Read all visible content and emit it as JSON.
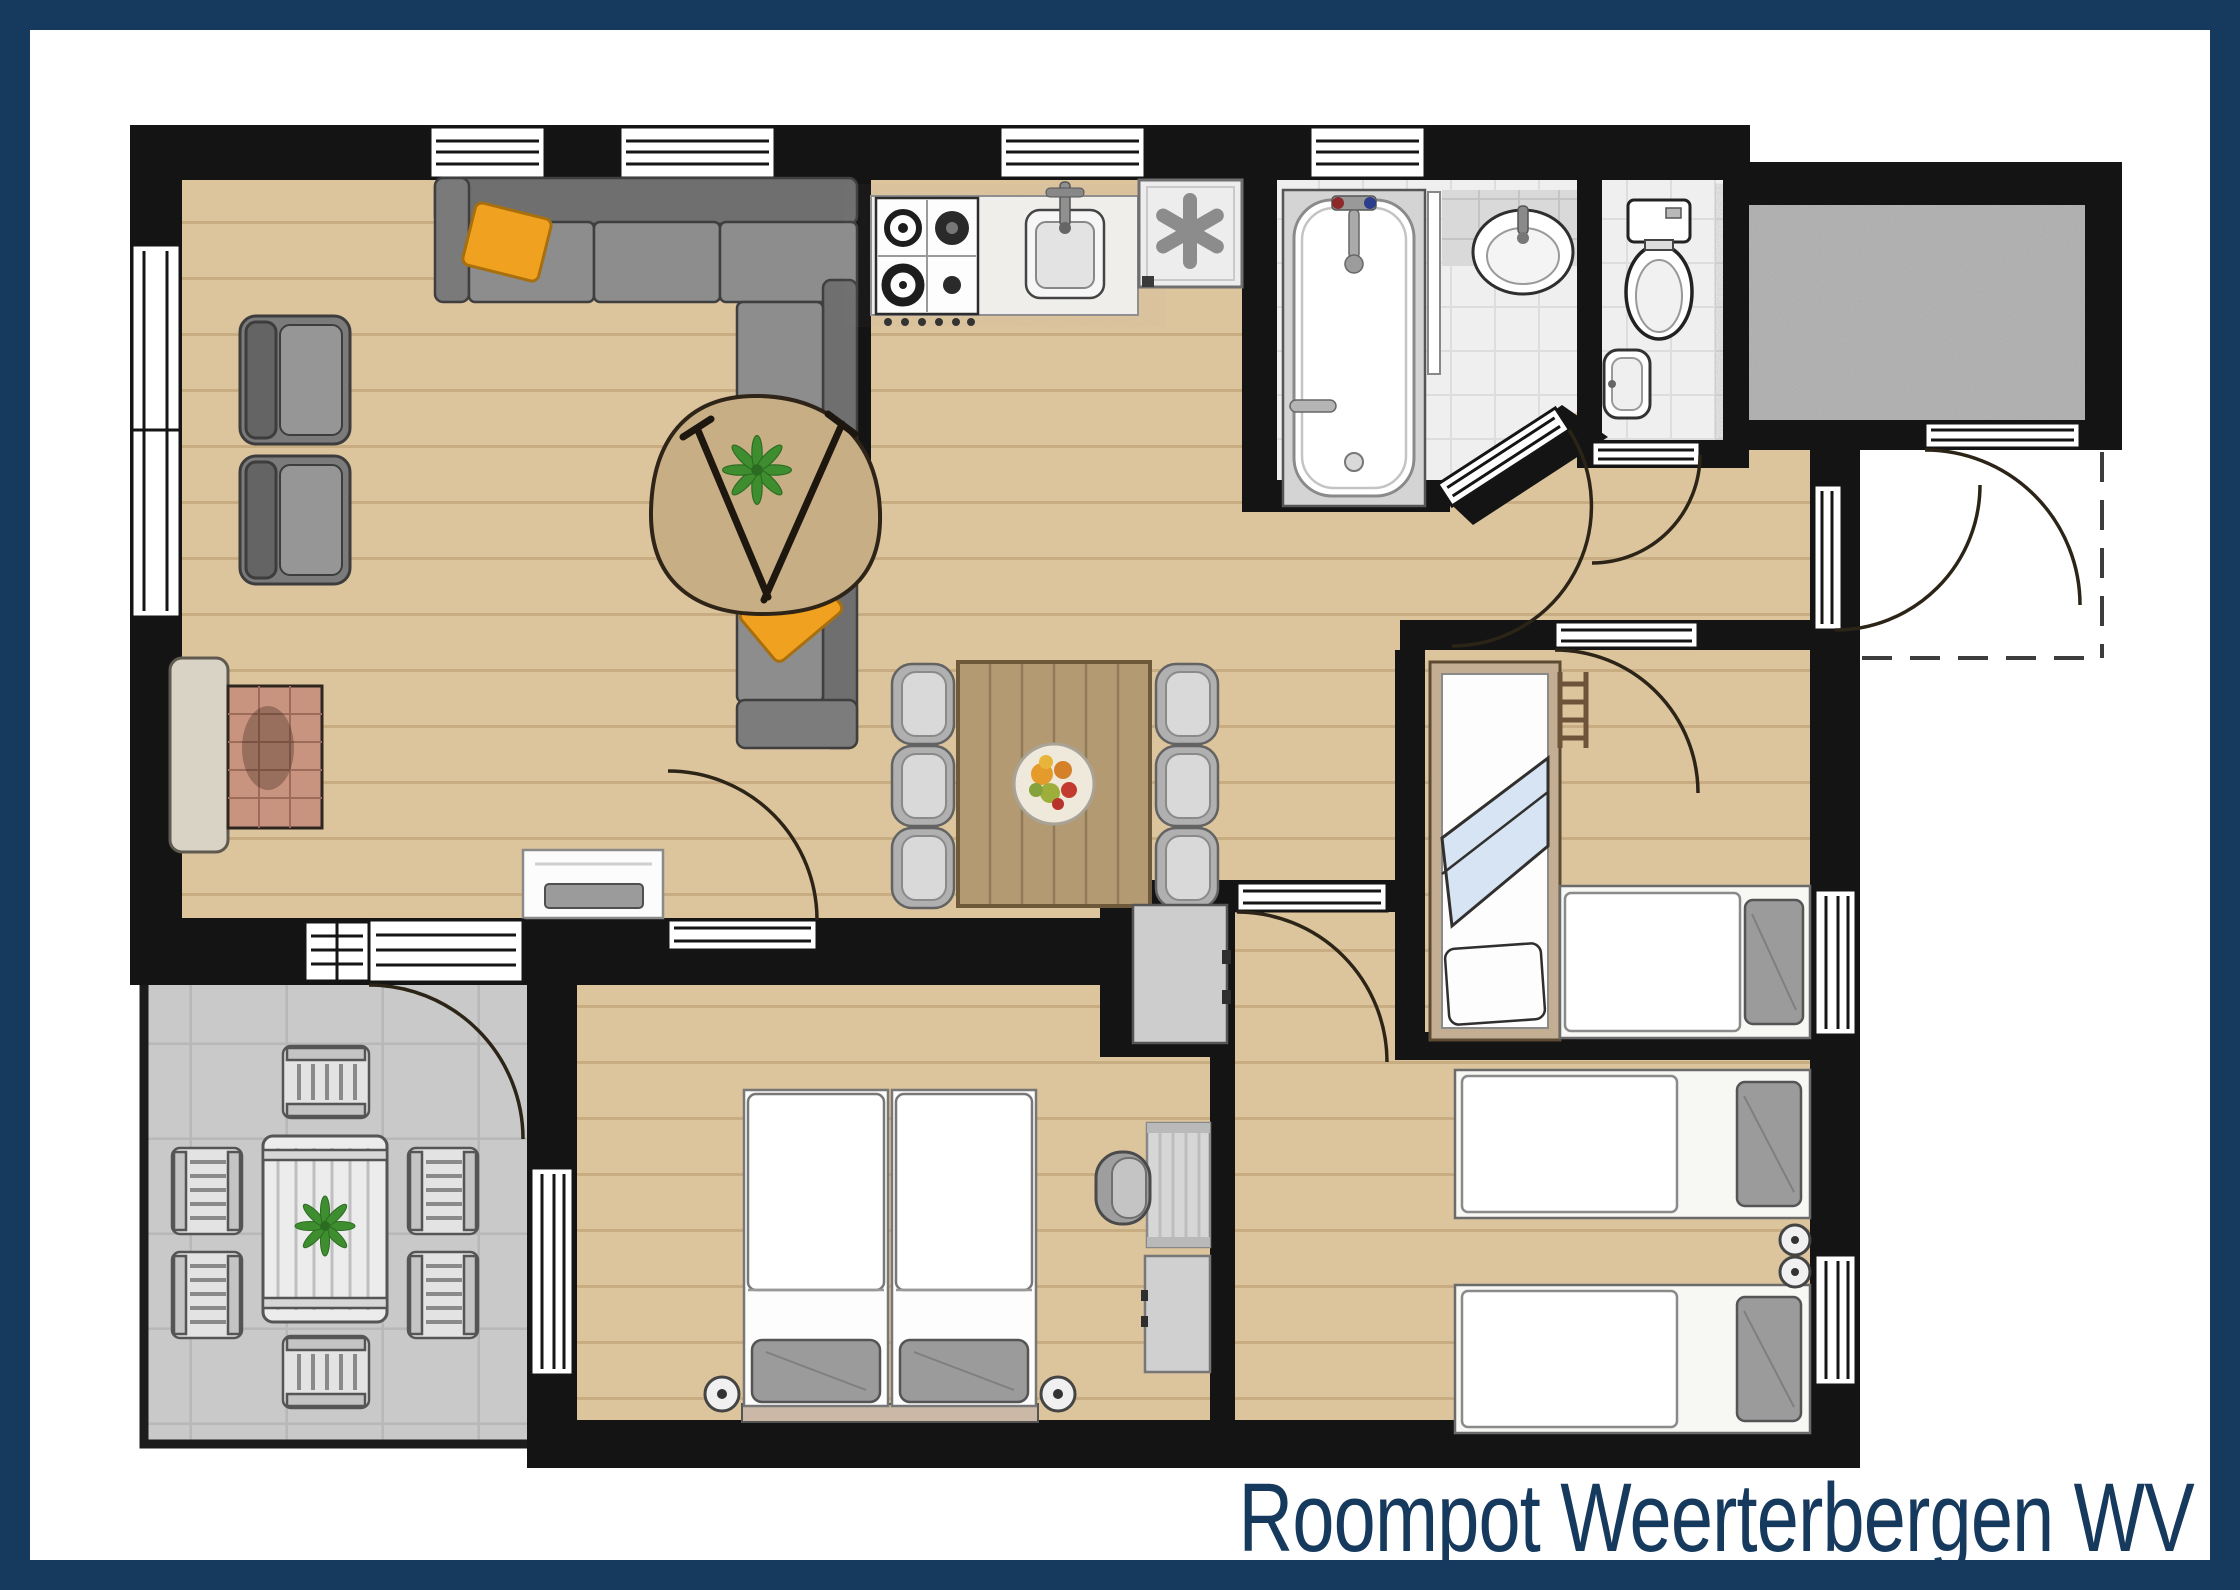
{
  "title": "Roompot Weerterbergen WV",
  "colors": {
    "navy": "#16395e",
    "wall": "#141414",
    "wood": "#dcc49d",
    "wood_line": "#c8ad82",
    "terrace": "#c9c9c9",
    "terrace_line": "#b8b8b8",
    "tile": "#efefef",
    "tile_line": "#dddddd",
    "storage_floor": "#b6b6b6",
    "fixture_white": "#ffffff",
    "sofa_gray": "#8d8d8d",
    "sofa_dark": "#6f6f6f",
    "pillow_orange": "#f0a11f",
    "dining_table_wood": "#b49a72",
    "coffee_table_wood": "#c7ae85",
    "brick": "#c9947f",
    "furniture_gray": "#cdcdcd",
    "plant_green": "#3e8e2f",
    "door_arc": "#2b2417"
  },
  "icons": {
    "freezer-icon": "asterisk-snowflake",
    "plant-icon": "leaf-star",
    "stove-icon": "four-burner-hob",
    "door-icon": "quarter-arc-swing",
    "window-icon": "triple-line-glazing"
  }
}
